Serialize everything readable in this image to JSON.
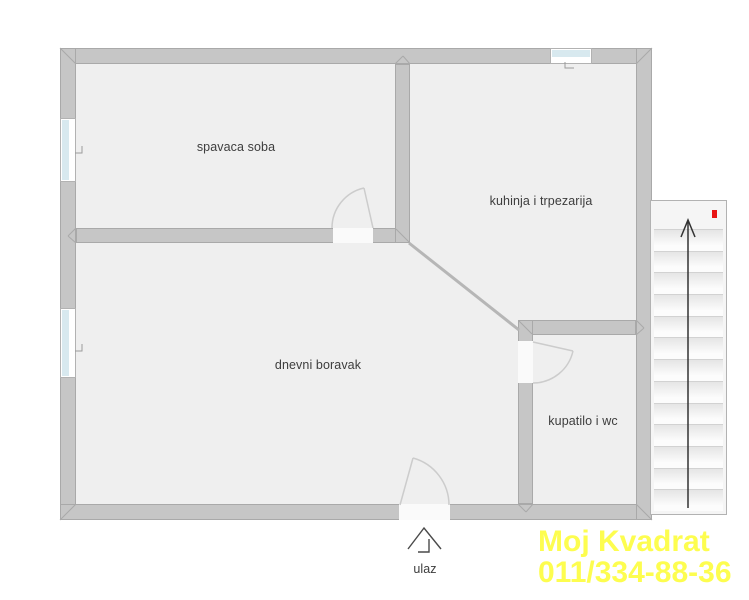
{
  "plan": {
    "rooms": {
      "bedroom": {
        "label": "spavaca soba"
      },
      "kitchen": {
        "label": "kuhinja i trpezarija"
      },
      "living": {
        "label": "dnevni boravak"
      },
      "bathroom": {
        "label": "kupatilo i wc"
      }
    },
    "entrance": {
      "label": "ulaz"
    },
    "stairs": {
      "steps": 14,
      "direction": "up",
      "marker_color": "#e81515"
    },
    "watermark": {
      "line1": "Moj Kvadrat",
      "line2": "011/334-88-36",
      "color": "#fdfd4f"
    }
  }
}
